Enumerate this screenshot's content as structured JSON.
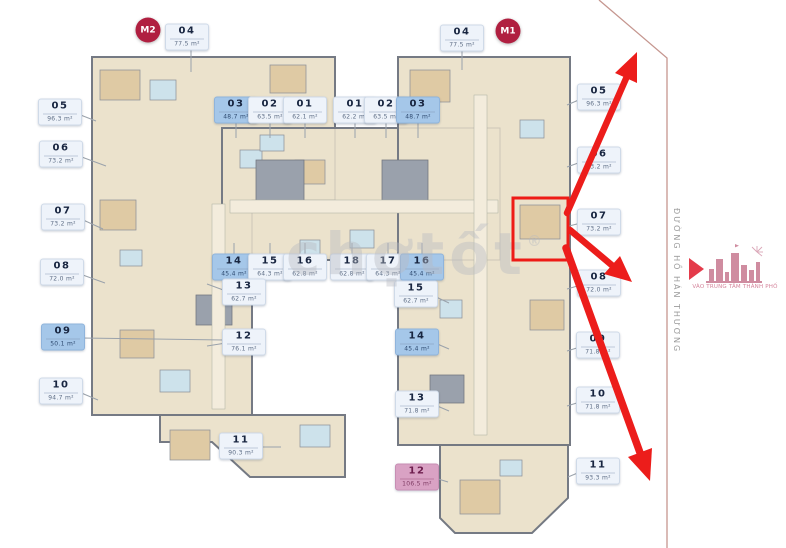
{
  "canvas": {
    "w": 786,
    "h": 548
  },
  "towers": [
    {
      "label": "M2",
      "x": 148,
      "y": 30
    },
    {
      "label": "M1",
      "x": 508,
      "y": 31
    }
  ],
  "units": [
    {
      "n": "04",
      "a": "77.5 m²",
      "x": 187,
      "y": 37,
      "v": "n",
      "l": [
        191,
        47,
        191,
        72
      ]
    },
    {
      "n": "05",
      "a": "96.3 m²",
      "x": 60,
      "y": 112,
      "v": "n",
      "l": [
        78,
        114,
        96,
        121
      ]
    },
    {
      "n": "06",
      "a": "73.2 m²",
      "x": 61,
      "y": 154,
      "v": "n",
      "l": [
        79,
        156,
        106,
        166
      ]
    },
    {
      "n": "07",
      "a": "73.2 m²",
      "x": 63,
      "y": 217,
      "v": "n",
      "l": [
        81,
        219,
        103,
        229
      ]
    },
    {
      "n": "08",
      "a": "72.0 m²",
      "x": 62,
      "y": 272,
      "v": "n",
      "l": [
        80,
        274,
        105,
        283
      ]
    },
    {
      "n": "09",
      "a": "50.1 m²",
      "x": 63,
      "y": 337,
      "v": "s",
      "l": [
        81,
        338,
        224,
        340
      ]
    },
    {
      "n": "10",
      "a": "94.7 m²",
      "x": 61,
      "y": 391,
      "v": "n",
      "l": [
        79,
        392,
        98,
        400
      ]
    },
    {
      "n": "11",
      "a": "90.3 m²",
      "x": 241,
      "y": 446,
      "v": "n",
      "l": [
        259,
        447,
        281,
        447
      ]
    },
    {
      "n": "03",
      "a": "48.7 m²",
      "x": 236,
      "y": 110,
      "v": "s",
      "l": [
        236,
        120,
        236,
        138
      ]
    },
    {
      "n": "02",
      "a": "63.5 m²",
      "x": 270,
      "y": 110,
      "v": "n",
      "l": [
        270,
        120,
        270,
        138
      ]
    },
    {
      "n": "01",
      "a": "62.1 m²",
      "x": 305,
      "y": 110,
      "v": "n",
      "l": [
        305,
        120,
        305,
        138
      ]
    },
    {
      "n": "01",
      "a": "62.2 m²",
      "x": 355,
      "y": 110,
      "v": "n",
      "l": [
        355,
        120,
        355,
        138
      ]
    },
    {
      "n": "02",
      "a": "63.5 m²",
      "x": 386,
      "y": 110,
      "v": "n",
      "l": [
        386,
        120,
        386,
        138
      ]
    },
    {
      "n": "03",
      "a": "48.7 m²",
      "x": 418,
      "y": 110,
      "v": "s",
      "l": [
        418,
        120,
        418,
        138
      ]
    },
    {
      "n": "14",
      "a": "45.4 m²",
      "x": 234,
      "y": 267,
      "v": "s",
      "l": [
        234,
        256,
        234,
        243
      ]
    },
    {
      "n": "15",
      "a": "64.3 m²",
      "x": 270,
      "y": 267,
      "v": "n",
      "l": [
        270,
        256,
        270,
        243
      ]
    },
    {
      "n": "16",
      "a": "62.8 m²",
      "x": 305,
      "y": 267,
      "v": "n",
      "l": [
        305,
        256,
        305,
        243
      ]
    },
    {
      "n": "18",
      "a": "62.8 m²",
      "x": 352,
      "y": 267,
      "v": "n",
      "l": [
        352,
        256,
        352,
        243
      ]
    },
    {
      "n": "17",
      "a": "64.3 m²",
      "x": 388,
      "y": 267,
      "v": "n",
      "l": [
        388,
        256,
        388,
        243
      ]
    },
    {
      "n": "16",
      "a": "45.4 m²",
      "x": 422,
      "y": 267,
      "v": "s",
      "l": [
        422,
        256,
        422,
        243
      ]
    },
    {
      "n": "13",
      "a": "62.7 m²",
      "x": 244,
      "y": 292,
      "v": "n",
      "l": [
        226,
        291,
        207,
        284
      ]
    },
    {
      "n": "12",
      "a": "76.1 m²",
      "x": 244,
      "y": 342,
      "v": "n",
      "l": [
        226,
        343,
        207,
        346
      ]
    },
    {
      "n": "15",
      "a": "62.7 m²",
      "x": 416,
      "y": 294,
      "v": "n",
      "l": [
        434,
        296,
        449,
        303
      ]
    },
    {
      "n": "14",
      "a": "45.4 m²",
      "x": 417,
      "y": 342,
      "v": "s",
      "l": [
        435,
        343,
        449,
        349
      ]
    },
    {
      "n": "13",
      "a": "71.8 m²",
      "x": 417,
      "y": 404,
      "v": "n",
      "l": [
        435,
        405,
        449,
        411
      ]
    },
    {
      "n": "04",
      "a": "77.5 m²",
      "x": 462,
      "y": 38,
      "v": "n",
      "l": [
        462,
        48,
        462,
        70
      ]
    },
    {
      "n": "05",
      "a": "96.3 m²",
      "x": 599,
      "y": 97,
      "v": "n",
      "l": [
        581,
        99,
        567,
        105
      ]
    },
    {
      "n": "06",
      "a": "73.2 m²",
      "x": 599,
      "y": 160,
      "v": "n",
      "l": [
        581,
        162,
        567,
        167
      ]
    },
    {
      "n": "07",
      "a": "73.2 m²",
      "x": 599,
      "y": 222,
      "v": "n",
      "l": [
        581,
        223,
        569,
        226
      ]
    },
    {
      "n": "08",
      "a": "72.0 m²",
      "x": 599,
      "y": 283,
      "v": "n",
      "l": [
        581,
        285,
        567,
        289
      ]
    },
    {
      "n": "09",
      "a": "71.8 m²",
      "x": 598,
      "y": 345,
      "v": "n",
      "l": [
        580,
        347,
        567,
        351
      ]
    },
    {
      "n": "10",
      "a": "71.8 m²",
      "x": 598,
      "y": 400,
      "v": "n",
      "l": [
        580,
        402,
        567,
        406
      ]
    },
    {
      "n": "11",
      "a": "93.3 m²",
      "x": 598,
      "y": 471,
      "v": "n",
      "l": [
        580,
        472,
        568,
        477
      ]
    },
    {
      "n": "12",
      "a": "106.5 m²",
      "x": 417,
      "y": 477,
      "v": "p",
      "l": [
        435,
        478,
        448,
        482
      ]
    }
  ],
  "street": {
    "name": "ĐƯỜNG HỒ HÁN THƯƠNG"
  },
  "landmark": {
    "caption": "VÀO TRUNG TÂM THÀNH PHỐ"
  },
  "watermark": {
    "text": "chợtốt",
    "reg": "®"
  },
  "highlight_box": {
    "x": 513,
    "y": 198,
    "w": 55,
    "h": 62
  },
  "arrows": [
    {
      "line": [
        567,
        213,
        628,
        74
      ],
      "w": 6.5,
      "head": "637,52 637,83 615,73"
    },
    {
      "line": [
        570,
        230,
        614,
        267
      ],
      "w": 6.5,
      "head": "632,282 604,274 620,256"
    },
    {
      "line": [
        566,
        248,
        643,
        461
      ],
      "w": 7.5,
      "head": "650,481 628,457 652,448"
    }
  ],
  "boundary": {
    "points": "599,0 667,58 667,548"
  },
  "plan": {
    "blocks": [
      "M 92,57 H 335 V 200 H 252 V 415 H 92 Z",
      "M 160,415 H 345 V 477 H 250 L 212,442 H 160 Z",
      "M 222,128 H 500 V 260 H 222 Z",
      "M 398,57 H 570 V 445 H 398 Z",
      "M 440,445 H 568 V 498 L 532,533 H 455 L 440,518 Z"
    ],
    "patches": [
      [
        100,
        70,
        40,
        30,
        "bed"
      ],
      [
        150,
        80,
        26,
        20,
        "bath"
      ],
      [
        270,
        65,
        36,
        28,
        "bed"
      ],
      [
        240,
        150,
        22,
        18,
        "bath"
      ],
      [
        295,
        160,
        30,
        24,
        "bed"
      ],
      [
        100,
        200,
        36,
        30,
        "bed"
      ],
      [
        120,
        250,
        22,
        16,
        "bath"
      ],
      [
        120,
        330,
        34,
        28,
        "bed"
      ],
      [
        160,
        370,
        30,
        22,
        "bath"
      ],
      [
        170,
        430,
        40,
        30,
        "bed"
      ],
      [
        300,
        425,
        30,
        22,
        "bath"
      ],
      [
        260,
        135,
        24,
        16,
        "bath"
      ],
      [
        300,
        240,
        20,
        14,
        "bath"
      ],
      [
        350,
        230,
        24,
        18,
        "bath"
      ],
      [
        410,
        70,
        40,
        32,
        "bed"
      ],
      [
        520,
        120,
        24,
        18,
        "bath"
      ],
      [
        520,
        205,
        40,
        34,
        "bed"
      ],
      [
        530,
        300,
        34,
        30,
        "bed"
      ],
      [
        440,
        300,
        22,
        18,
        "bath"
      ],
      [
        460,
        480,
        40,
        34,
        "bed"
      ],
      [
        500,
        460,
        22,
        16,
        "bath"
      ],
      [
        256,
        160,
        48,
        42,
        "core"
      ],
      [
        382,
        160,
        46,
        42,
        "core"
      ],
      [
        196,
        295,
        36,
        30,
        "core"
      ],
      [
        430,
        375,
        34,
        28,
        "core"
      ],
      [
        230,
        200,
        268,
        13,
        "hall"
      ],
      [
        212,
        204,
        13,
        205,
        "hall"
      ],
      [
        474,
        95,
        13,
        340,
        "hall"
      ]
    ]
  }
}
